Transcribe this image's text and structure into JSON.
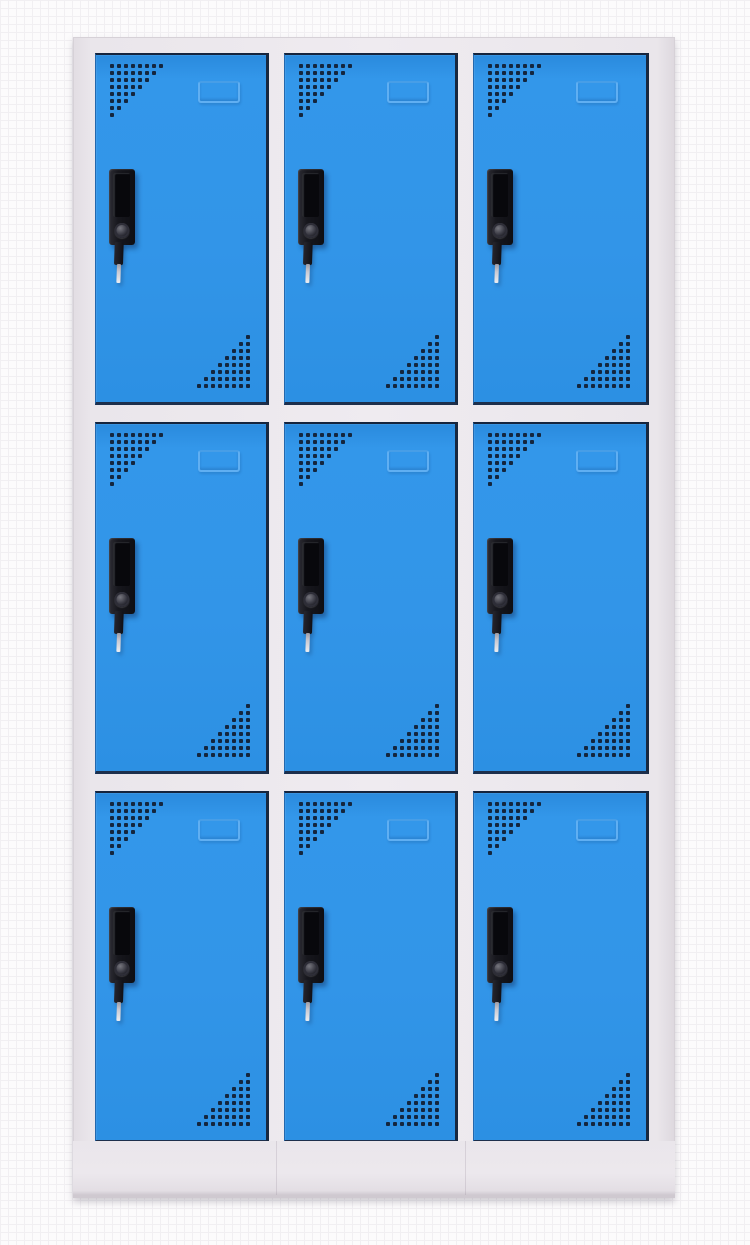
{
  "scene": {
    "subject": "nine-door steel locker cabinet",
    "view": "front product photo on plain textured white background",
    "colors": {
      "background": "#fcfbfc",
      "background_grid_line": "#f1eff2",
      "frame_grey": "#eae6eb",
      "door_blue": "#2f96e8",
      "door_edge_dark": "#18283f",
      "perforation_dot": "#14263e",
      "handle_black": "#17171d",
      "handle_recess": "#08080c",
      "key_metal": "#c9c9d1"
    },
    "grid": {
      "rows": 3,
      "columns": 3,
      "door_count": 9
    }
  },
  "door_features": {
    "vent_top_left_rows": [
      8,
      7,
      6,
      5,
      4,
      3,
      2,
      1
    ],
    "vent_bottom_right_rows": [
      1,
      2,
      3,
      4,
      5,
      6,
      7,
      8
    ],
    "label_holder": "embossed blank card frame near top of each door",
    "handle": "recessed black vertical pull with round lock cylinder",
    "key": "key inserted in each lock, hanging downward"
  },
  "doors": [
    {
      "id": "door-1",
      "row": 1,
      "col": 1
    },
    {
      "id": "door-2",
      "row": 1,
      "col": 2
    },
    {
      "id": "door-3",
      "row": 1,
      "col": 3
    },
    {
      "id": "door-4",
      "row": 2,
      "col": 1
    },
    {
      "id": "door-5",
      "row": 2,
      "col": 2
    },
    {
      "id": "door-6",
      "row": 2,
      "col": 3
    },
    {
      "id": "door-7",
      "row": 3,
      "col": 1
    },
    {
      "id": "door-8",
      "row": 3,
      "col": 2
    },
    {
      "id": "door-9",
      "row": 3,
      "col": 3
    }
  ]
}
